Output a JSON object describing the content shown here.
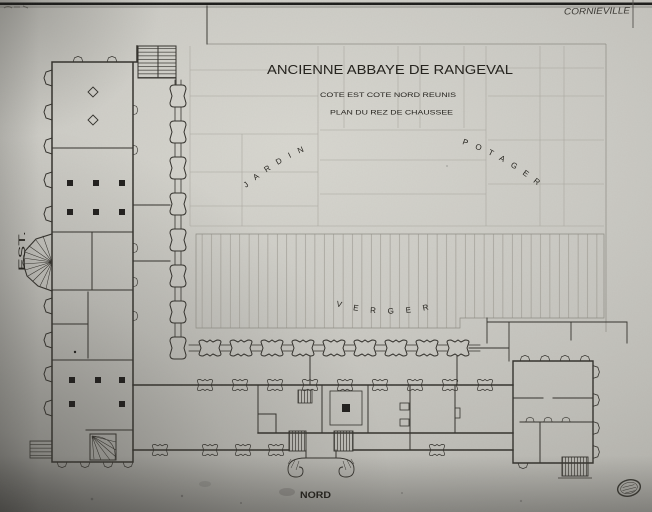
{
  "plan": {
    "handwritten_note": "CORNIEVILLE",
    "title": "ANCIENNE ABBAYE DE RANGEVAL",
    "subtitle_line1": "COTE EST COTE NORD REUNIS",
    "subtitle_line2": "PLAN DU REZ DE CHAUSSEE",
    "areas": {
      "jardin": "JARDIN",
      "potager": "POTAGER",
      "verger": "VERGER"
    },
    "orientation": {
      "east": "EST.",
      "north": "NORD"
    },
    "colors": {
      "ink": "#34322d",
      "paper": "#cbcac4",
      "faint_line": "#a6a49c",
      "stripe": "#98968e"
    }
  }
}
